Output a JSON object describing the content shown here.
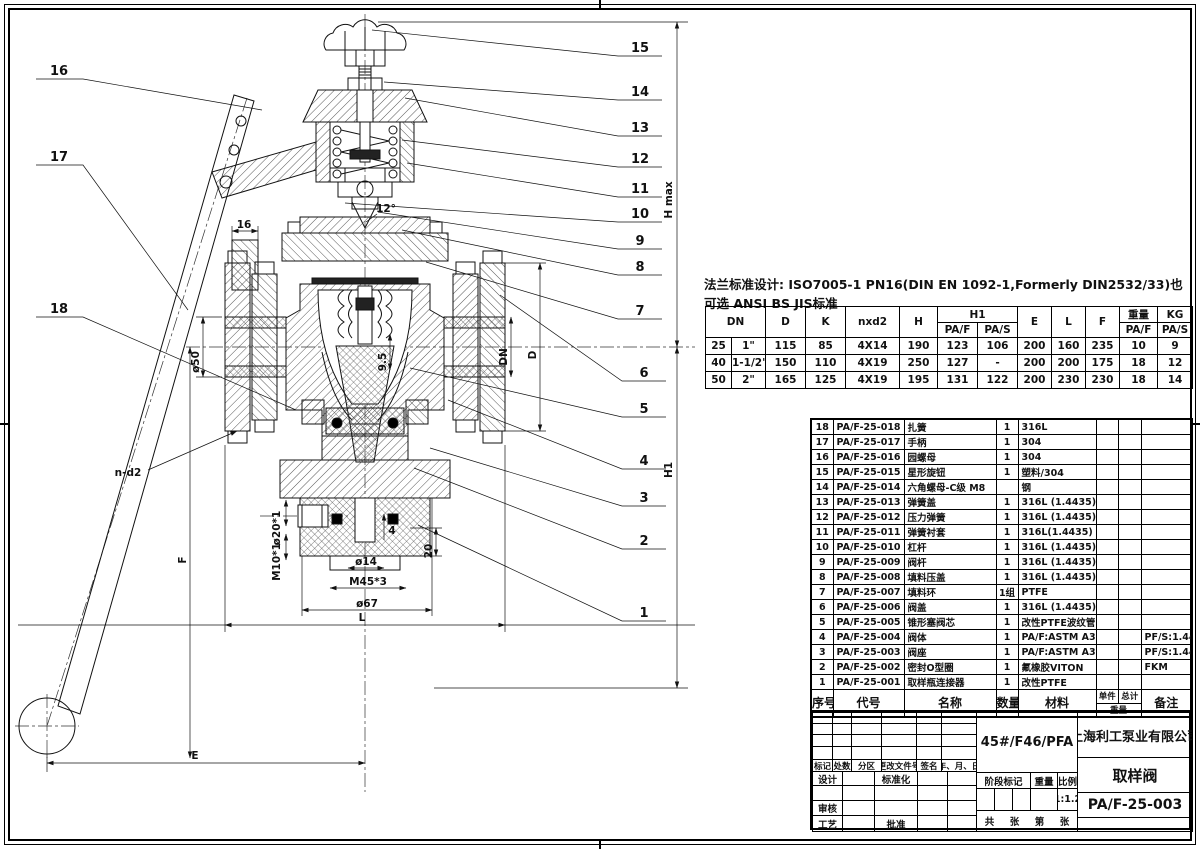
{
  "sheet": {
    "flange_note": "法兰标准设计: ISO7005-1 PN16(DIN EN 1092-1,Formerly DIN2532/33)也可选 ANSI BS JIS标准"
  },
  "dim_table": {
    "col_headers": {
      "dn": "DN",
      "d": "D",
      "k": "K",
      "nxd2": "nxd2",
      "h": "H",
      "h1": "H1",
      "paf": "PA/F",
      "pas": "PA/S",
      "e": "E",
      "l": "L",
      "f": "F",
      "weight": "重量",
      "kg": "KG"
    },
    "rows": [
      [
        "25",
        "1\"",
        "115",
        "85",
        "4X14",
        "190",
        "123",
        "106",
        "200",
        "160",
        "235",
        "10",
        "9"
      ],
      [
        "40",
        "1-1/2\"",
        "150",
        "110",
        "4X19",
        "250",
        "127",
        "-",
        "200",
        "200",
        "175",
        "18",
        "12"
      ],
      [
        "50",
        "2\"",
        "165",
        "125",
        "4X19",
        "195",
        "131",
        "122",
        "200",
        "230",
        "230",
        "18",
        "14"
      ]
    ]
  },
  "bom": {
    "headers": {
      "no": "序号",
      "code": "代号",
      "name": "名称",
      "qty": "数量",
      "material": "材料",
      "unit": "单件",
      "total": "总计",
      "weight": "重量",
      "remark": "备注"
    },
    "rows": [
      {
        "no": "18",
        "code": "PA/F-25-018",
        "name": "扎簧",
        "qty": "1",
        "material": "316L",
        "remark": ""
      },
      {
        "no": "17",
        "code": "PA/F-25-017",
        "name": "手柄",
        "qty": "1",
        "material": "304",
        "remark": ""
      },
      {
        "no": "16",
        "code": "PA/F-25-016",
        "name": "园螺母",
        "qty": "1",
        "material": "304",
        "remark": ""
      },
      {
        "no": "15",
        "code": "PA/F-25-015",
        "name": "星形旋钮",
        "qty": "1",
        "material": "塑料/304",
        "remark": ""
      },
      {
        "no": "14",
        "code": "PA/F-25-014",
        "name": "六角螺母-C级 M8",
        "qty": "",
        "material": "钢",
        "remark": ""
      },
      {
        "no": "13",
        "code": "PA/F-25-013",
        "name": "弹簧盖",
        "qty": "1",
        "material": "316L (1.4435)",
        "remark": ""
      },
      {
        "no": "12",
        "code": "PA/F-25-012",
        "name": "压力弹簧",
        "qty": "1",
        "material": "316L (1.4435)",
        "remark": ""
      },
      {
        "no": "11",
        "code": "PA/F-25-011",
        "name": "弹簧衬套",
        "qty": "1",
        "material": "316L(1.4435)",
        "remark": ""
      },
      {
        "no": "10",
        "code": "PA/F-25-010",
        "name": "杠杆",
        "qty": "1",
        "material": "316L (1.4435)",
        "remark": ""
      },
      {
        "no": "9",
        "code": "PA/F-25-009",
        "name": "阀杆",
        "qty": "1",
        "material": "316L (1.4435)",
        "remark": ""
      },
      {
        "no": "8",
        "code": "PA/F-25-008",
        "name": "填料压盖",
        "qty": "1",
        "material": "316L (1.4435)",
        "remark": ""
      },
      {
        "no": "7",
        "code": "PA/F-25-007",
        "name": "填料环",
        "qty": "1组",
        "material": "PTFE",
        "remark": ""
      },
      {
        "no": "6",
        "code": "PA/F-25-006",
        "name": "阀盖",
        "qty": "1",
        "material": "316L (1.4435)",
        "remark": ""
      },
      {
        "no": "5",
        "code": "PA/F-25-005",
        "name": "锥形塞阀芯",
        "qty": "1",
        "material": "改性PTFE波纹管",
        "remark": ""
      },
      {
        "no": "4",
        "code": "PA/F-25-004",
        "name": "阀体",
        "qty": "1",
        "material": "PA/F:ASTM A395/PFA",
        "remark": "PF/S:1.4435"
      },
      {
        "no": "3",
        "code": "PA/F-25-003",
        "name": "阀座",
        "qty": "1",
        "material": "PA/F:ASTM A395/PFA",
        "remark": "PF/S:1.4435"
      },
      {
        "no": "2",
        "code": "PA/F-25-002",
        "name": "密封O型圈",
        "qty": "1",
        "material": "氟橡胶VITON",
        "remark": "FKM"
      },
      {
        "no": "1",
        "code": "PA/F-25-001",
        "name": "取样瓶连接器",
        "qty": "1",
        "material": "改性PTFE",
        "remark": ""
      }
    ]
  },
  "title_block": {
    "material_spec": "45#/F46/PFA",
    "company": "上海利工泵业有限公司",
    "product_name": "取样阀",
    "drawing_no": "PA/F-25-003",
    "scale": "1:1.2",
    "labels": {
      "mark": "标记",
      "count": "处数",
      "zone": "分区",
      "change_doc": "更改文件号",
      "sign": "签名",
      "date": "年、月、日",
      "design": "设计",
      "standardize": "标准化",
      "review": "审核",
      "process": "工艺",
      "approve": "批准",
      "stage_mark": "阶段标记",
      "weight": "重量",
      "scale_label": "比例",
      "total_sheets": "共",
      "sheet": "张",
      "sheet_no": "第",
      "sheet2": "张"
    }
  },
  "drawing": {
    "callouts": [
      "1",
      "2",
      "3",
      "4",
      "5",
      "6",
      "7",
      "8",
      "9",
      "10",
      "11",
      "12",
      "13",
      "14",
      "15",
      "16",
      "17",
      "18"
    ],
    "dims": {
      "hmax": "H max",
      "h1": "H1",
      "e": "E",
      "f": "F",
      "l": "L",
      "nd2": "n-d2",
      "dia50": "ø50",
      "w16": "16",
      "ang12": "12°",
      "gap95": "9.5",
      "dn": "DN",
      "d": "D",
      "dia20": "ø20*1",
      "m10": "M10*1",
      "dia14": "ø14",
      "m45": "M45*3",
      "dia67": "ø67",
      "depth20": "20",
      "len4": "4"
    }
  }
}
